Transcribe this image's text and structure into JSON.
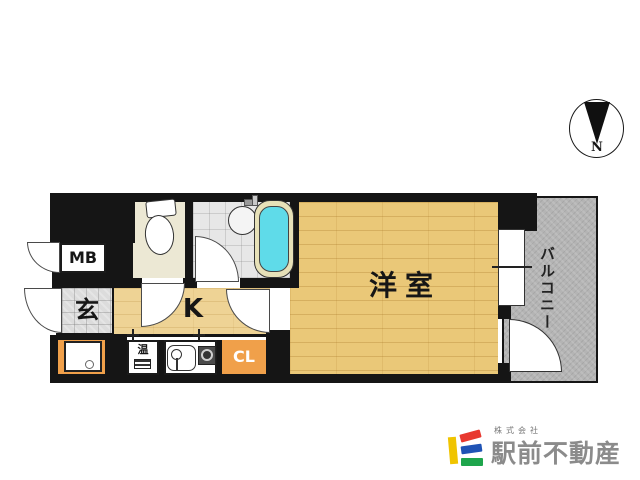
{
  "floor_plan": {
    "rooms": {
      "meter_box": "MB",
      "entrance": "玄",
      "kitchen": "K",
      "western_room": "洋室",
      "closet": "CL",
      "water_heater": "温",
      "balcony": "バルコニー"
    },
    "compass": {
      "north": "N"
    },
    "colors": {
      "wood_floor": "#eac878",
      "kitchen_floor": "#eed395",
      "balcony_gray": "#b4b4b4",
      "accent_orange": "#f0a04a",
      "bathtub_cyan": "#5fdbe9",
      "wall_black": "#151515"
    }
  },
  "branding": {
    "company_type": "株式会社",
    "company_name": "駅前不動産",
    "logo_colors": {
      "yellow": "#f0c400",
      "red": "#e8382f",
      "blue": "#1f53b5",
      "green": "#1ea54c",
      "text_gray": "#8b8b8b"
    }
  }
}
